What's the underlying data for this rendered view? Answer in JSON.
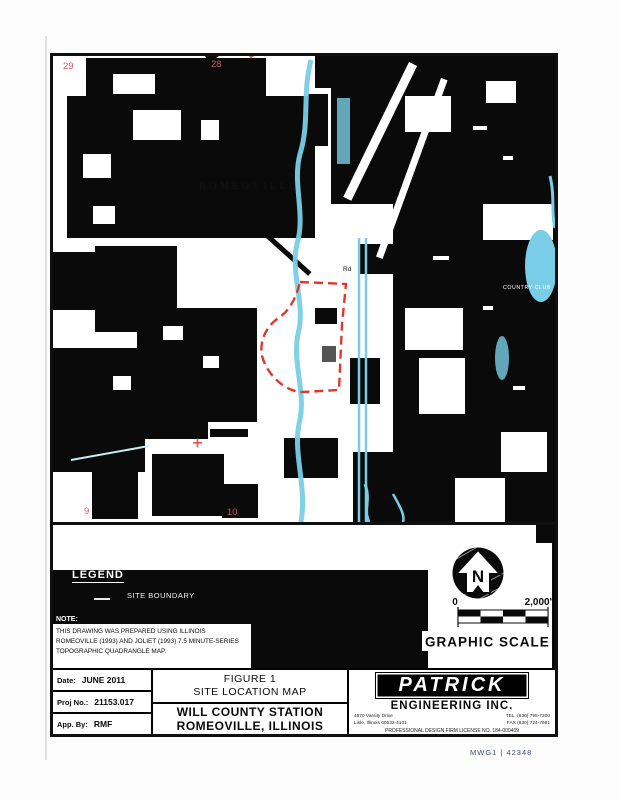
{
  "map": {
    "town_label": "ROMEOVILLE",
    "country_club_label": "COUNTRY CLUB",
    "road_label": "Rd",
    "sections": {
      "nw": "29",
      "ne": "28",
      "sw": "9",
      "se": "10"
    },
    "colors": {
      "water": "#79cde6",
      "boundary": "#d93b2b",
      "secnum": "#cf5a6a"
    }
  },
  "legend": {
    "title": "LEGEND",
    "site_boundary_label": "SITE BOUNDARY"
  },
  "note": {
    "heading": "NOTE:",
    "line1": "THIS DRAWING WAS PREPARED USING ILLINOIS",
    "line2": "ROMEOVILLE (1993) AND JOLIET (1993) 7.5 MINUTE-SERIES",
    "line3": "TOPOGRAPHIC QUADRANGLE MAP."
  },
  "compass": {
    "north_letter": "N"
  },
  "scale": {
    "zero": "0",
    "max": "2,000'",
    "caption": "GRAPHIC SCALE"
  },
  "titleblock": {
    "date_label": "Date:",
    "date_value": "JUNE 2011",
    "proj_label": "Proj No.:",
    "proj_value": "21153.017",
    "app_label": "App. By:",
    "app_value": "RMF",
    "figure_line1": "FIGURE 1",
    "figure_line2": "SITE LOCATION MAP",
    "project_line1": "WILL COUNTY STATION",
    "project_line2": "ROMEOVILLE, ILLINOIS",
    "firm": {
      "name": "PATRICK",
      "subtitle": "ENGINEERING INC.",
      "address_line1": "4970 Varsity Drive",
      "address_line2": "Lisle, Illinois 60532-4101",
      "tel": "TEL. (630) 795-7200",
      "fax": "FAX (630) 724-7681",
      "license": "PROFESSIONAL DESIGN FIRM LICENSE NO. 184-000409"
    }
  },
  "document": {
    "corner_note": "MWG1  |  42348"
  }
}
